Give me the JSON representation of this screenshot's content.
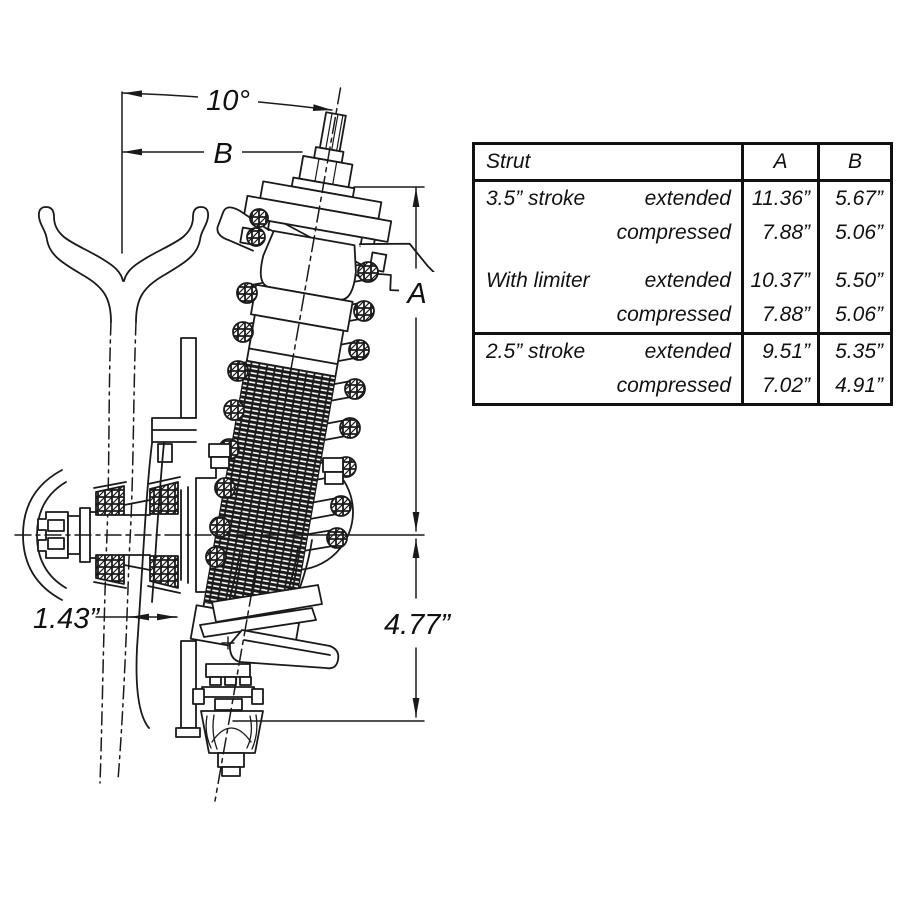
{
  "diagram": {
    "title": "strut-suspension-cross-section",
    "ink_color": "#1a1a1a",
    "background": "#ffffff",
    "dimensions": {
      "camber_angle": "10°",
      "dim_b_label": "B",
      "dim_a_label": "A",
      "hub_offset": "1.43”",
      "lower_height": "4.77”"
    }
  },
  "table": {
    "header": {
      "strut": "Strut",
      "a": "A",
      "b": "B"
    },
    "sections": [
      {
        "rows": [
          {
            "label": "3.5” stroke",
            "state": "extended",
            "a": "11.36”",
            "b": "5.67”",
            "gap_after": false
          },
          {
            "label": "",
            "state": "compressed",
            "a": "7.88”",
            "b": "5.06”",
            "gap_after": true
          },
          {
            "label": "With limiter",
            "state": "extended",
            "a": "10.37”",
            "b": "5.50”",
            "gap_after": false
          },
          {
            "label": "",
            "state": "compressed",
            "a": "7.88”",
            "b": "5.06”",
            "gap_after": false
          }
        ]
      },
      {
        "rows": [
          {
            "label": "2.5” stroke",
            "state": "extended",
            "a": "9.51”",
            "b": "5.35”",
            "gap_after": false
          },
          {
            "label": "",
            "state": "compressed",
            "a": "7.02”",
            "b": "4.91”",
            "gap_after": false
          }
        ]
      }
    ]
  }
}
